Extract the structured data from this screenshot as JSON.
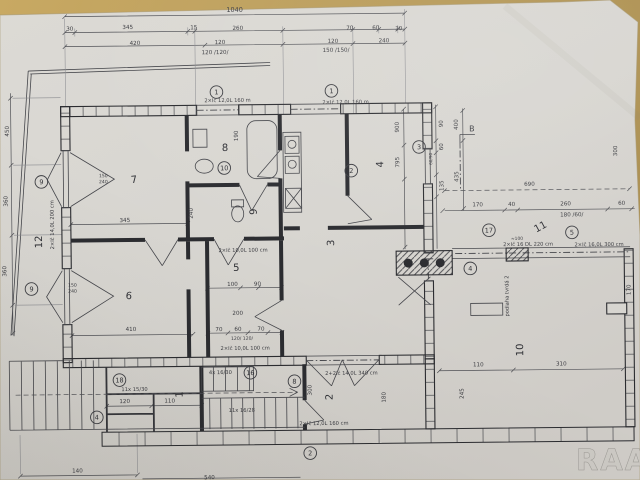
{
  "photo": {
    "watermark": "RAA",
    "colors": {
      "table": "#c2a45f",
      "table_dark": "#ab8e4e",
      "paper": "#d8d6d1",
      "ink": "#3c3d42",
      "wall": "#2b2c30",
      "watermark": "#ccc9c4"
    }
  },
  "plan": {
    "rooms": [
      {
        "n": "7",
        "x": 135,
        "y": 181,
        "r": -6
      },
      {
        "n": "8",
        "x": 226,
        "y": 150
      },
      {
        "n": "6",
        "x": 128,
        "y": 297,
        "r": 6
      },
      {
        "n": "5",
        "x": 236,
        "y": 270
      },
      {
        "n": "3",
        "x": 334,
        "y": 243,
        "r": -90
      },
      {
        "n": "4",
        "x": 384,
        "y": 165,
        "r": -90
      },
      {
        "n": "9",
        "x": 257,
        "y": 211,
        "r": -90
      },
      {
        "n": "2",
        "x": 331,
        "y": 397,
        "r": -90
      },
      {
        "n": "1",
        "x": 181,
        "y": 393,
        "r": -90
      },
      {
        "n": "10",
        "x": 522,
        "y": 352,
        "r": -90
      },
      {
        "n": "11",
        "x": 542,
        "y": 232,
        "r": -28
      },
      {
        "n": "12",
        "x": 42,
        "y": 239,
        "r": -90
      }
    ],
    "tags": [
      {
        "n": "1",
        "x": 218,
        "y": 91
      },
      {
        "n": "1",
        "x": 333,
        "y": 91
      },
      {
        "n": "3",
        "x": 420,
        "y": 148
      },
      {
        "n": "2",
        "x": 352,
        "y": 171
      },
      {
        "n": "10",
        "x": 225,
        "y": 167
      },
      {
        "n": "9",
        "x": 42,
        "y": 179
      },
      {
        "n": "9",
        "x": 31,
        "y": 286
      },
      {
        "n": "18",
        "x": 118,
        "y": 378
      },
      {
        "n": "16",
        "x": 249,
        "y": 372
      },
      {
        "n": "8",
        "x": 293,
        "y": 381
      },
      {
        "n": "4",
        "x": 95,
        "y": 415
      },
      {
        "n": "2",
        "x": 308,
        "y": 453
      },
      {
        "n": "4",
        "x": 470,
        "y": 270
      },
      {
        "n": "5",
        "x": 572,
        "y": 235
      },
      {
        "n": "17",
        "x": 489,
        "y": 232
      }
    ],
    "dims": [
      {
        "t": "1040",
        "x": 237,
        "y": 11,
        "s": 6.5
      },
      {
        "t": "30",
        "x": 72,
        "y": 28
      },
      {
        "t": "345",
        "x": 130,
        "y": 27
      },
      {
        "t": "15",
        "x": 196,
        "y": 28
      },
      {
        "t": "260",
        "x": 240,
        "y": 29
      },
      {
        "t": "70",
        "x": 352,
        "y": 30
      },
      {
        "t": "60",
        "x": 378,
        "y": 30
      },
      {
        "t": "30",
        "x": 401,
        "y": 31
      },
      {
        "t": "420",
        "x": 137,
        "y": 43
      },
      {
        "t": "120",
        "x": 222,
        "y": 43
      },
      {
        "t": "120",
        "x": 335,
        "y": 43
      },
      {
        "t": "240",
        "x": 386,
        "y": 43
      },
      {
        "t": "120 /120/",
        "x": 217,
        "y": 53
      },
      {
        "t": "150 /150/",
        "x": 338,
        "y": 52
      },
      {
        "t": "450",
        "x": 10,
        "y": 128,
        "r": -90
      },
      {
        "t": "360",
        "x": 8,
        "y": 198,
        "r": -90
      },
      {
        "t": "360",
        "x": 6,
        "y": 268,
        "r": -90
      },
      {
        "t": "345",
        "x": 125,
        "y": 220
      },
      {
        "t": "410",
        "x": 130,
        "y": 329
      },
      {
        "t": "240",
        "x": 193,
        "y": 212,
        "r": -90
      },
      {
        "t": "190",
        "x": 239,
        "y": 135,
        "r": -90
      },
      {
        "t": "100",
        "x": 232,
        "y": 285
      },
      {
        "t": "90",
        "x": 257,
        "y": 285
      },
      {
        "t": "200",
        "x": 237,
        "y": 314
      },
      {
        "t": "70",
        "x": 218,
        "y": 330
      },
      {
        "t": "60",
        "x": 237,
        "y": 330
      },
      {
        "t": "70",
        "x": 260,
        "y": 330
      },
      {
        "t": "120/ 120/",
        "x": 241,
        "y": 339,
        "s": 4.6
      },
      {
        "t": "150",
        "x": 104,
        "y": 175,
        "s": 4.6
      },
      {
        "t": "240",
        "x": 104,
        "y": 181,
        "s": 4.6
      },
      {
        "t": "150",
        "x": 72,
        "y": 284,
        "s": 4.6
      },
      {
        "t": "240",
        "x": 72,
        "y": 290,
        "s": 4.6
      },
      {
        "t": "690",
        "x": 530,
        "y": 188
      },
      {
        "t": "170",
        "x": 478,
        "y": 208
      },
      {
        "t": "40",
        "x": 512,
        "y": 208
      },
      {
        "t": "260",
        "x": 566,
        "y": 208
      },
      {
        "t": "60",
        "x": 622,
        "y": 208
      },
      {
        "t": "180 /60/",
        "x": 572,
        "y": 219
      },
      {
        "t": "110",
        "x": 477,
        "y": 368
      },
      {
        "t": "310",
        "x": 560,
        "y": 368
      },
      {
        "t": "120",
        "x": 123,
        "y": 401
      },
      {
        "t": "110",
        "x": 168,
        "y": 401
      },
      {
        "t": "140",
        "x": 75,
        "y": 470
      },
      {
        "t": "540",
        "x": 207,
        "y": 478
      },
      {
        "t": "900",
        "x": 400,
        "y": 128,
        "r": -90
      },
      {
        "t": "795",
        "x": 400,
        "y": 163,
        "r": -90
      },
      {
        "t": "400",
        "x": 459,
        "y": 126,
        "r": -90
      },
      {
        "t": "435",
        "x": 459,
        "y": 178,
        "r": -90
      },
      {
        "t": "90",
        "x": 444,
        "y": 125,
        "r": -90
      },
      {
        "t": "60",
        "x": 444,
        "y": 148,
        "r": -90
      },
      {
        "t": "60/90",
        "x": 433,
        "y": 160,
        "r": -90,
        "s": 4.2
      },
      {
        "t": "135",
        "x": 444,
        "y": 187,
        "r": -90
      },
      {
        "t": "300",
        "x": 618,
        "y": 154,
        "r": -90
      },
      {
        "t": "300",
        "x": 310,
        "y": 390,
        "r": -90
      },
      {
        "t": "245",
        "x": 462,
        "y": 395,
        "r": -90
      },
      {
        "t": "180",
        "x": 384,
        "y": 398,
        "r": -90
      },
      {
        "t": "170",
        "x": 630,
        "y": 293,
        "r": -90
      },
      {
        "t": "≈100",
        "x": 517,
        "y": 242,
        "s": 4.4
      }
    ],
    "notes": [
      {
        "t": "2×Ič 12,0L 160 m",
        "x": 229,
        "y": 101
      },
      {
        "t": "2×Ič 12,0L 160 m",
        "x": 347,
        "y": 104
      },
      {
        "t": "2×Ič 16 DL 220 cm",
        "x": 528,
        "y": 248
      },
      {
        "t": "2×Ič 16,0L 300 cm",
        "x": 599,
        "y": 249
      },
      {
        "t": "2+2Ič 14,0L 340 cm",
        "x": 350,
        "y": 375
      },
      {
        "t": "2×Ič 12,0L 160 cm",
        "x": 322,
        "y": 425
      },
      {
        "t": "2×Ič 10,0L 100 cm",
        "x": 244,
        "y": 349
      },
      {
        "t": "2×Ič 10,0L 100 cm",
        "x": 243,
        "y": 251
      },
      {
        "t": "2×Ič 14,0L 200 cm",
        "x": 54,
        "y": 222,
        "r": -90
      },
      {
        "t": "4x 16/30",
        "x": 219,
        "y": 373
      },
      {
        "t": "11x 16/28",
        "x": 240,
        "y": 411
      },
      {
        "t": "11x 15/30",
        "x": 133,
        "y": 389
      },
      {
        "t": "podlaha tvrdá 2",
        "x": 508,
        "y": 298,
        "r": -90
      },
      {
        "t": "B",
        "x": 473,
        "y": 133,
        "s": 8
      }
    ]
  }
}
